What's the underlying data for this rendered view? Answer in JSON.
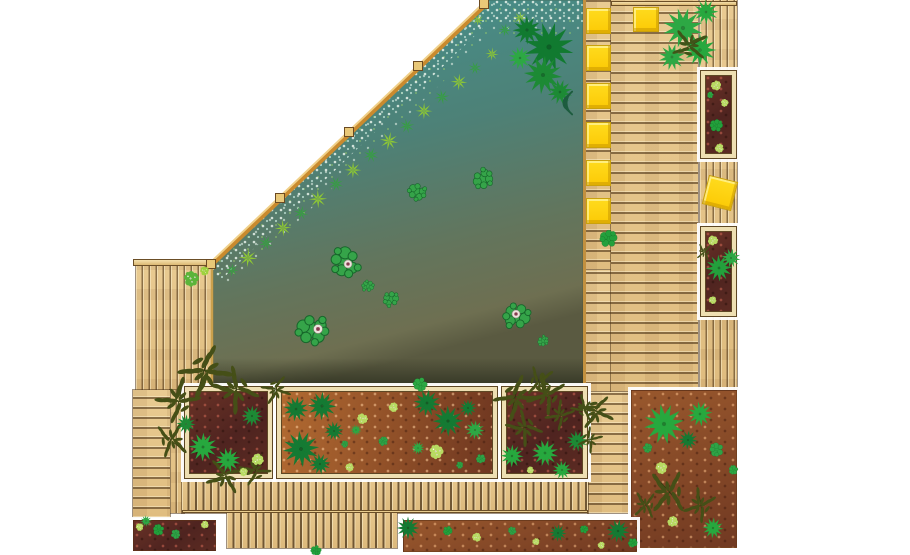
{
  "meta": {
    "title": "garden-terrace-pond-plan",
    "description": "Top-down landscape plan: angled natural pond with lily pads and gravel bank, timber decking, raised planting beds with shrubs and grasses, yellow seat cushions",
    "canvas": {
      "w": 910,
      "h": 555
    },
    "background": "#ffffff"
  },
  "palette": {
    "deck_wood": "#e6c68c",
    "deck_line": "#6b4e26",
    "beam_wood": "#e9c878",
    "pond_top": "#459390",
    "pond_bottom": "#5a5a41",
    "soil_dark": "#4f2420",
    "soil_orange": "#8f4f28",
    "cushion_yellow": "#fccf05",
    "plant_dark": "#157a33",
    "plant_mid": "#2da844",
    "plant_light": "#b8da62",
    "shrub_olive": "#454f17"
  },
  "pond": {
    "polygon": [
      [
        486,
        0
      ],
      [
        583,
        0
      ],
      [
        583,
        385
      ],
      [
        213,
        385
      ],
      [
        213,
        263
      ]
    ],
    "gravel_path": "M211,269 L482,8 L583,8",
    "beam": [
      {
        "x1": 211,
        "y1": 265,
        "x2": 488,
        "y2": 2,
        "w": 5,
        "c": "#c98a2e"
      },
      {
        "x1": 210,
        "y1": 263,
        "x2": 487,
        "y2": 0,
        "w": 2,
        "c": "#f0d089"
      }
    ],
    "edges": [
      {
        "x1": 584.5,
        "y1": 0,
        "x2": 584.5,
        "y2": 385,
        "w": 3,
        "c": "#c2903f"
      },
      {
        "x1": 213,
        "y1": 386.5,
        "x2": 583,
        "y2": 386.5,
        "w": 4,
        "c": "#e6cb95"
      },
      {
        "x1": 213,
        "y1": 389,
        "x2": 583,
        "y2": 389,
        "w": 1.5,
        "c": "#6b4a22"
      },
      {
        "x1": 212,
        "y1": 263,
        "x2": 212,
        "y2": 385,
        "w": 2.5,
        "c": "#caa04c"
      }
    ],
    "blocks": [
      [
        211,
        264
      ],
      [
        280,
        198
      ],
      [
        349,
        132
      ],
      [
        418,
        66
      ],
      [
        484,
        4
      ]
    ]
  },
  "decks": [
    {
      "name": "deck-left-terrace",
      "x": 136,
      "y": 262,
      "w": 77,
      "h": 128,
      "planks": "pv"
    },
    {
      "name": "deck-left-sliver",
      "x": 170,
      "y": 390,
      "w": 14,
      "h": 123,
      "planks": "pv"
    },
    {
      "name": "deck-left-strip",
      "x": 133,
      "y": 390,
      "w": 37,
      "h": 127,
      "planks": "ph"
    },
    {
      "name": "deck-pool-edge-strip",
      "x": 583,
      "y": 0,
      "w": 28,
      "h": 270,
      "planks": "ph"
    },
    {
      "name": "deck-pool-edge-lower",
      "x": 583,
      "y": 270,
      "w": 28,
      "h": 122,
      "planks": "ph"
    },
    {
      "name": "deck-main-right",
      "x": 611,
      "y": 0,
      "w": 87,
      "h": 392,
      "planks": "ph"
    },
    {
      "name": "deck-path-strip",
      "x": 588,
      "y": 392,
      "w": 41,
      "h": 121,
      "planks": "ph"
    },
    {
      "name": "deck-right-outer-strip",
      "x": 700,
      "y": 0,
      "w": 37,
      "h": 390,
      "planks": "pv"
    },
    {
      "name": "deck-boardwalk",
      "x": 182,
      "y": 480,
      "w": 406,
      "h": 33,
      "planks": "board"
    },
    {
      "name": "deck-boardwalk-extension",
      "x": 227,
      "y": 513,
      "w": 170,
      "h": 35,
      "planks": "board"
    },
    {
      "name": "beam-left-terrace-top",
      "x": 133,
      "y": 259,
      "w": 82,
      "h": 7,
      "kind": "beam"
    },
    {
      "name": "beam-top-right",
      "x": 611,
      "y": 1,
      "w": 126,
      "h": 5,
      "kind": "beam"
    },
    {
      "name": "beam-boardwalk-joint",
      "x": 182,
      "y": 510,
      "w": 406,
      "h": 3,
      "kind": "beam"
    }
  ],
  "planters": [
    {
      "name": "planter-left",
      "x": 185,
      "y": 387,
      "w": 87,
      "h": 91,
      "soil": "maroon",
      "frame": true
    },
    {
      "name": "planter-middle",
      "x": 277,
      "y": 387,
      "w": 220,
      "h": 91,
      "soil": "orange",
      "frame": true
    },
    {
      "name": "planter-right",
      "x": 502,
      "y": 387,
      "w": 85,
      "h": 91,
      "soil": "maroon",
      "frame": true
    },
    {
      "name": "bed-bottom-right",
      "x": 631,
      "y": 390,
      "w": 106,
      "h": 158,
      "soil": "red",
      "frame": false
    },
    {
      "name": "planter-east-top",
      "x": 701,
      "y": 71,
      "w": 35,
      "h": 87,
      "soil": "maroon",
      "frame": true
    },
    {
      "name": "planter-east-mid",
      "x": 701,
      "y": 227,
      "w": 35,
      "h": 89,
      "soil": "maroon",
      "frame": true
    },
    {
      "name": "bed-bottom-left",
      "x": 133,
      "y": 520,
      "w": 83,
      "h": 31,
      "soil": "maroon",
      "frame": false
    },
    {
      "name": "bed-bottom-strip",
      "x": 403,
      "y": 520,
      "w": 234,
      "h": 32,
      "soil": "red",
      "frame": false
    }
  ],
  "cushions": [
    {
      "x": 586,
      "y": 8,
      "w": 25,
      "h": 26,
      "r": 0
    },
    {
      "x": 586,
      "y": 45,
      "w": 25,
      "h": 26,
      "r": 0
    },
    {
      "x": 586,
      "y": 83,
      "w": 25,
      "h": 26,
      "r": 0
    },
    {
      "x": 586,
      "y": 122,
      "w": 25,
      "h": 26,
      "r": 0
    },
    {
      "x": 586,
      "y": 160,
      "w": 25,
      "h": 26,
      "r": 0
    },
    {
      "x": 586,
      "y": 198,
      "w": 25,
      "h": 26,
      "r": 0
    },
    {
      "x": 633,
      "y": 7,
      "w": 26,
      "h": 25,
      "r": 0
    },
    {
      "x": 705,
      "y": 178,
      "w": 30,
      "h": 30,
      "r": 14
    }
  ],
  "plants": [
    [
      "grass",
      248,
      258,
      22,
      "#8fc932"
    ],
    [
      "grass",
      266,
      243,
      18,
      "#35a03f"
    ],
    [
      "grass",
      283,
      228,
      20,
      "#8fc932"
    ],
    [
      "grass",
      301,
      213,
      18,
      "#35a03f"
    ],
    [
      "grass",
      318,
      199,
      22,
      "#8fc932"
    ],
    [
      "grass",
      336,
      184,
      18,
      "#35a03f"
    ],
    [
      "grass",
      353,
      170,
      20,
      "#8fc932"
    ],
    [
      "grass",
      371,
      155,
      18,
      "#35a03f"
    ],
    [
      "grass",
      389,
      141,
      22,
      "#8fc932"
    ],
    [
      "grass",
      407,
      126,
      18,
      "#35a03f"
    ],
    [
      "grass",
      424,
      111,
      20,
      "#8fc932"
    ],
    [
      "grass",
      442,
      97,
      18,
      "#35a03f"
    ],
    [
      "grass",
      459,
      82,
      20,
      "#8fc932"
    ],
    [
      "grass",
      475,
      68,
      16,
      "#35a03f"
    ],
    [
      "grass",
      492,
      54,
      16,
      "#8fc932"
    ],
    [
      "grass",
      505,
      30,
      16,
      "#35a03f"
    ],
    [
      "grass",
      520,
      18,
      16,
      "#8fc932"
    ],
    [
      "grass",
      232,
      270,
      16,
      "#35a03f"
    ],
    [
      "grass",
      478,
      20,
      14,
      "#8fc932"
    ],
    [
      "spiky",
      549,
      47,
      52,
      "#117a30"
    ],
    [
      "spiky",
      543,
      75,
      40,
      "#1d8a35"
    ],
    [
      "spiky",
      527,
      30,
      30,
      "#117a30"
    ],
    [
      "spiky",
      560,
      92,
      26,
      "#1d8a35"
    ],
    [
      "spiky",
      520,
      58,
      24,
      "#2da844"
    ],
    [
      "ripple",
      563,
      103,
      38,
      "#1d5c3e"
    ],
    [
      "lily",
      417,
      192,
      30,
      "#35a449"
    ],
    [
      "lily",
      483,
      179,
      34,
      "#35a449"
    ],
    [
      "lily",
      345,
      262,
      50,
      "#35a449"
    ],
    [
      "lily",
      368,
      286,
      20,
      "#35a449"
    ],
    [
      "lily",
      312,
      330,
      52,
      "#35a449"
    ],
    [
      "lily",
      391,
      299,
      26,
      "#35a449"
    ],
    [
      "lily",
      517,
      316,
      44,
      "#35a449"
    ],
    [
      "lily",
      543,
      341,
      18,
      "#35a449"
    ],
    [
      "flower",
      348,
      264,
      9,
      "#ece4de"
    ],
    [
      "flower",
      318,
      329,
      10,
      "#ece4de"
    ],
    [
      "flower",
      516,
      314,
      9,
      "#ece4de"
    ],
    [
      "bush",
      608,
      238,
      30,
      "#23a03c"
    ],
    [
      "bush",
      420,
      385,
      24,
      "#2da844"
    ],
    [
      "bush",
      316,
      551,
      18,
      "#23a03c"
    ],
    [
      "clump",
      192,
      279,
      26,
      "#5cb43a"
    ],
    [
      "clump",
      205,
      271,
      15,
      "#9ed23f"
    ],
    [
      "spiky",
      683,
      28,
      42,
      "#2da844"
    ],
    [
      "spiky",
      700,
      50,
      34,
      "#27a83e"
    ],
    [
      "spiky",
      672,
      57,
      28,
      "#2da844"
    ],
    [
      "spiky",
      706,
      12,
      26,
      "#27a83e"
    ],
    [
      "shrub",
      690,
      45,
      34,
      "#3f5518"
    ],
    [
      "clump",
      716,
      86,
      17,
      "#b8da62"
    ],
    [
      "clump",
      725,
      103,
      13,
      "#b8da62"
    ],
    [
      "bush",
      716,
      125,
      22,
      "#23a03c"
    ],
    [
      "clump",
      719,
      148,
      15,
      "#b8da62"
    ],
    [
      "bush",
      710,
      95,
      11,
      "#2da844"
    ],
    [
      "clump",
      713,
      240,
      17,
      "#b8da62"
    ],
    [
      "spiky",
      719,
      268,
      28,
      "#23a03c"
    ],
    [
      "spiky",
      731,
      258,
      20,
      "#2da844"
    ],
    [
      "clump",
      713,
      300,
      13,
      "#b8da62"
    ],
    [
      "shrub",
      704,
      252,
      16,
      "#47521a"
    ],
    [
      "shrub",
      205,
      372,
      50,
      "#454f17"
    ],
    [
      "shrub",
      178,
      400,
      42,
      "#454f17"
    ],
    [
      "shrub",
      235,
      390,
      44,
      "#454f17"
    ],
    [
      "shrub",
      172,
      440,
      34,
      "#454f17"
    ],
    [
      "shrub",
      255,
      470,
      30,
      "#454f17"
    ],
    [
      "shrub",
      225,
      476,
      36,
      "#454f17"
    ],
    [
      "spiky",
      203,
      447,
      30,
      "#27a83e"
    ],
    [
      "spiky",
      228,
      460,
      26,
      "#27a83e"
    ],
    [
      "spiky",
      186,
      424,
      20,
      "#1d8a35"
    ],
    [
      "clump",
      258,
      459,
      20,
      "#b8da62"
    ],
    [
      "clump",
      244,
      472,
      14,
      "#b8da62"
    ],
    [
      "spiky",
      252,
      416,
      22,
      "#1d8a35"
    ],
    [
      "shrub",
      276,
      390,
      28,
      "#454f17"
    ],
    [
      "spiky",
      296,
      409,
      26,
      "#157a33"
    ],
    [
      "spiky",
      322,
      406,
      30,
      "#157a33"
    ],
    [
      "spiky",
      334,
      431,
      20,
      "#157a33"
    ],
    [
      "spiky",
      301,
      449,
      38,
      "#157a33"
    ],
    [
      "spiky",
      320,
      464,
      22,
      "#157a33"
    ],
    [
      "spiky",
      427,
      403,
      28,
      "#157a33"
    ],
    [
      "spiky",
      448,
      421,
      32,
      "#157a33"
    ],
    [
      "spiky",
      468,
      408,
      18,
      "#157a33"
    ],
    [
      "spiky",
      356,
      430,
      12,
      "#2da844"
    ],
    [
      "spiky",
      475,
      430,
      20,
      "#2da844"
    ],
    [
      "spiky",
      418,
      448,
      14,
      "#2da844"
    ],
    [
      "clump",
      362,
      419,
      18,
      "#b8da62"
    ],
    [
      "clump",
      393,
      407,
      16,
      "#b8da62"
    ],
    [
      "clump",
      350,
      467,
      14,
      "#b8da62"
    ],
    [
      "clump",
      437,
      452,
      24,
      "#b8da62"
    ],
    [
      "bush",
      383,
      441,
      16,
      "#2fa246"
    ],
    [
      "bush",
      481,
      459,
      16,
      "#2fa246"
    ],
    [
      "bush",
      345,
      444,
      12,
      "#2fa246"
    ],
    [
      "bush",
      460,
      465,
      12,
      "#2fa246"
    ],
    [
      "shrub",
      516,
      398,
      42,
      "#454f17"
    ],
    [
      "shrub",
      546,
      394,
      38,
      "#454f17"
    ],
    [
      "shrub",
      524,
      428,
      34,
      "#454f17"
    ],
    [
      "shrub",
      560,
      415,
      28,
      "#454f17"
    ],
    [
      "shrub",
      585,
      408,
      26,
      "#454f17"
    ],
    [
      "shrub",
      540,
      382,
      30,
      "#454f17"
    ],
    [
      "spiky",
      512,
      456,
      24,
      "#27a83e"
    ],
    [
      "spiky",
      545,
      453,
      28,
      "#27a83e"
    ],
    [
      "spiky",
      562,
      470,
      20,
      "#27a83e"
    ],
    [
      "spiky",
      577,
      441,
      22,
      "#1d8a35"
    ],
    [
      "clump",
      530,
      470,
      12,
      "#b8da62"
    ],
    [
      "shrub",
      596,
      412,
      34,
      "#454f17"
    ],
    [
      "shrub",
      590,
      440,
      24,
      "#454f17"
    ],
    [
      "spiky",
      664,
      424,
      42,
      "#27a83e"
    ],
    [
      "spiky",
      700,
      414,
      26,
      "#27a83e"
    ],
    [
      "spiky",
      688,
      440,
      20,
      "#157a33"
    ],
    [
      "bush",
      716,
      450,
      24,
      "#2fa246"
    ],
    [
      "bush",
      648,
      448,
      16,
      "#2fa246"
    ],
    [
      "clump",
      662,
      468,
      20,
      "#b8da62"
    ],
    [
      "clump",
      673,
      522,
      18,
      "#b8da62"
    ],
    [
      "shrub",
      668,
      492,
      42,
      "#454f17"
    ],
    [
      "shrub",
      700,
      505,
      32,
      "#454f17"
    ],
    [
      "shrub",
      645,
      505,
      26,
      "#454f17"
    ],
    [
      "spiky",
      713,
      528,
      22,
      "#27a83e"
    ],
    [
      "bush",
      733,
      470,
      16,
      "#2da844"
    ],
    [
      "clump",
      140,
      527,
      13,
      "#b8da62"
    ],
    [
      "bush",
      158,
      530,
      19,
      "#23a03c"
    ],
    [
      "bush",
      176,
      534,
      16,
      "#2fa246"
    ],
    [
      "clump",
      205,
      525,
      13,
      "#b8da62"
    ],
    [
      "spiky",
      146,
      521,
      12,
      "#2da844"
    ],
    [
      "spiky",
      408,
      528,
      24,
      "#157a33"
    ],
    [
      "bush",
      448,
      531,
      16,
      "#23a03c"
    ],
    [
      "clump",
      477,
      537,
      15,
      "#b8da62"
    ],
    [
      "bush",
      512,
      531,
      14,
      "#2fa246"
    ],
    [
      "clump",
      536,
      542,
      12,
      "#b8da62"
    ],
    [
      "spiky",
      558,
      533,
      18,
      "#157a33"
    ],
    [
      "bush",
      584,
      529,
      14,
      "#23a03c"
    ],
    [
      "clump",
      601,
      545,
      12,
      "#b8da62"
    ],
    [
      "spiky",
      618,
      531,
      24,
      "#157a33"
    ],
    [
      "bush",
      633,
      543,
      16,
      "#23a03c"
    ]
  ]
}
